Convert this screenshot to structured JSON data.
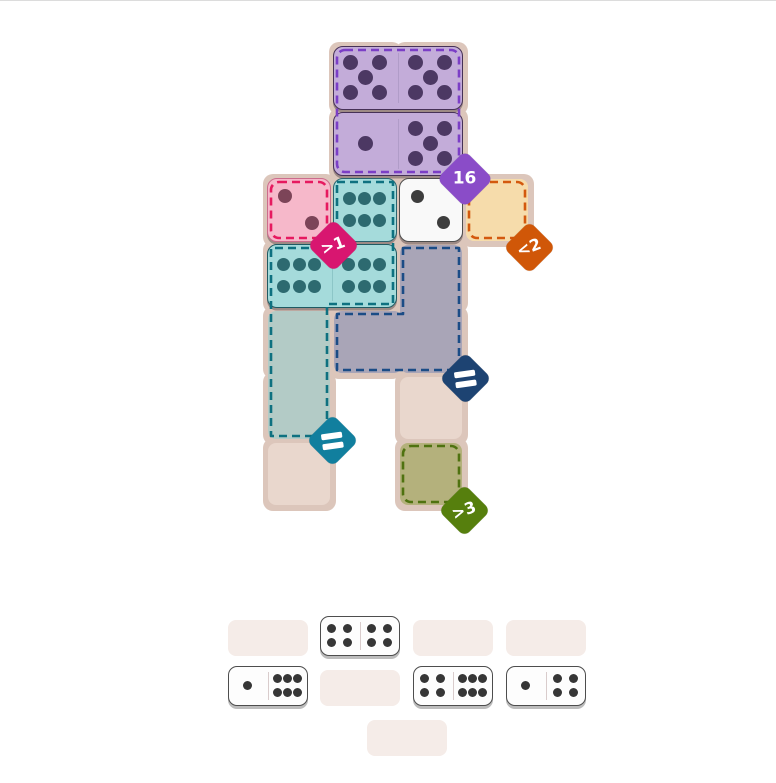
{
  "page": {
    "background": "#ffffff",
    "divider": {
      "y": 592,
      "color": "#dcdcdc"
    }
  },
  "board": {
    "grid": {
      "origin_x": 266,
      "origin_y": 45,
      "cell": 66
    },
    "casing_color": "#dcc6bb",
    "cell_color": "#e9d7cd",
    "base_cells": [
      [
        1,
        0
      ],
      [
        2,
        0
      ],
      [
        1,
        1
      ],
      [
        2,
        1
      ],
      [
        0,
        2
      ],
      [
        1,
        2
      ],
      [
        2,
        2
      ],
      [
        3,
        2
      ],
      [
        0,
        3
      ],
      [
        1,
        3
      ],
      [
        2,
        3
      ],
      [
        0,
        4
      ],
      [
        1,
        4
      ],
      [
        2,
        4
      ],
      [
        0,
        5
      ],
      [
        2,
        5
      ],
      [
        0,
        6
      ],
      [
        2,
        6
      ]
    ],
    "region_fills": [
      {
        "name": "region-cell-orange",
        "x": 466,
        "y": 179,
        "w": 62,
        "h": 62,
        "color": "#f6dcab"
      },
      {
        "name": "region-cell-olive",
        "x": 400,
        "y": 443,
        "w": 62,
        "h": 62,
        "color": "#b4b17c"
      },
      {
        "name": "region-cells-teal",
        "x": 268,
        "y": 311,
        "w": 62,
        "h": 128,
        "color": "#b3cbc6"
      },
      {
        "name": "region-cells-blue-right",
        "x": 400,
        "y": 245,
        "w": 62,
        "h": 128,
        "color": "#a9a5b7"
      },
      {
        "name": "region-cell-blue-left",
        "x": 334,
        "y": 311,
        "w": 68,
        "h": 62,
        "color": "#a9a5b7"
      }
    ],
    "region_outlines": [
      {
        "name": "purple",
        "type": "rect",
        "x": 337,
        "y": 50,
        "w": 122,
        "h": 122,
        "color": "#7b3ec6"
      },
      {
        "name": "pink",
        "type": "rect",
        "x": 271,
        "y": 182,
        "w": 56,
        "h": 56,
        "color": "#e6195f"
      },
      {
        "name": "orange",
        "type": "rect",
        "x": 469,
        "y": 182,
        "w": 56,
        "h": 56,
        "color": "#d3590e"
      },
      {
        "name": "olive",
        "type": "rect",
        "x": 403,
        "y": 446,
        "w": 56,
        "h": 56,
        "color": "#4f7210"
      },
      {
        "name": "teal",
        "type": "path",
        "d": "M 337 182 H 393 V 304 H 327 V 436 H 271 V 248 H 337 Z",
        "color": "#0e7180"
      },
      {
        "name": "blue",
        "type": "path",
        "d": "M 403 248 H 459 V 370 H 337 V 314 H 403 Z",
        "color": "#1b4c86"
      }
    ],
    "tiles": [
      {
        "name": "tile-domino-5-5",
        "x": 333,
        "y": 46,
        "w": 130,
        "h": 64,
        "halves": [
          5,
          5
        ],
        "fill": "#c3acd9",
        "stroke": "#463157",
        "divider": "#b09cc8",
        "pip": "#4c3863",
        "pip_size": 15
      },
      {
        "name": "tile-domino-1-5",
        "x": 333,
        "y": 112,
        "w": 130,
        "h": 64,
        "halves": [
          1,
          5
        ],
        "fill": "#c3acd9",
        "stroke": "#463157",
        "divider": "#b09cc8",
        "pip": "#4c3863",
        "pip_size": 15
      },
      {
        "name": "tile-half-2-pink",
        "x": 267,
        "y": 178,
        "w": 64,
        "h": 64,
        "halves": [
          2
        ],
        "fill": "#f6b8ca",
        "stroke": "#cc6c8c",
        "divider": null,
        "pip": "#7c4458",
        "pip_size": 14
      },
      {
        "name": "tile-half-6-teal",
        "x": 333,
        "y": 178,
        "w": 64,
        "h": 64,
        "halves": [
          6
        ],
        "fill": "#a5dbdb",
        "stroke": "#2a6570",
        "divider": null,
        "pip": "#2d6a70",
        "pip_size": 13
      },
      {
        "name": "tile-half-2-white",
        "x": 399,
        "y": 178,
        "w": 64,
        "h": 64,
        "halves": [
          2
        ],
        "fill": "#f9f9f9",
        "stroke": "#4e4e4e",
        "divider": null,
        "pip": "#3d3d3d",
        "pip_size": 13
      },
      {
        "name": "tile-domino-6-6",
        "x": 267,
        "y": 244,
        "w": 130,
        "h": 64,
        "halves": [
          6,
          6
        ],
        "fill": "#a5dbdb",
        "stroke": "#1f5b63",
        "divider": "#8cc6c7",
        "pip": "#2d6a70",
        "pip_size": 13
      }
    ],
    "badges": [
      {
        "name": "badge-sum-16",
        "label": "16",
        "kind": "text",
        "color": "#8a4cc8",
        "cx": 465,
        "cy": 179,
        "size": 40,
        "tilt": 0,
        "font": 17
      },
      {
        "name": "badge-gt-1",
        "label": ">1",
        "kind": "text",
        "color": "#d81670",
        "cx": 333,
        "cy": 245,
        "size": 37,
        "tilt": -20,
        "font": 16
      },
      {
        "name": "badge-lt-2",
        "label": "<2",
        "kind": "text",
        "color": "#d05708",
        "cx": 529,
        "cy": 247,
        "size": 37,
        "tilt": -20,
        "font": 16
      },
      {
        "name": "badge-eq-navy",
        "label": "=",
        "kind": "equals",
        "color": "#1d4372",
        "cx": 465,
        "cy": 378,
        "size": 37,
        "tilt": -8,
        "font": 16
      },
      {
        "name": "badge-eq-teal",
        "label": "=",
        "kind": "equals",
        "color": "#117f9e",
        "cx": 332,
        "cy": 440,
        "size": 37,
        "tilt": -8,
        "font": 16
      },
      {
        "name": "badge-gt-3",
        "label": ">3",
        "kind": "text",
        "color": "#567f0d",
        "cx": 464,
        "cy": 510,
        "size": 37,
        "tilt": -20,
        "font": 16
      }
    ]
  },
  "tray": {
    "slot_color": "#f5ece8",
    "slot_w": 80,
    "slot_h": 36,
    "slots": [
      {
        "x": 228,
        "y": 620
      },
      {
        "x": 413,
        "y": 620
      },
      {
        "x": 506,
        "y": 620
      },
      {
        "x": 320,
        "y": 670
      },
      {
        "x": 367,
        "y": 720
      }
    ],
    "domino_w": 80,
    "domino_h": 40,
    "domino_fill": "#fdfdfd",
    "domino_stroke": "#4d4d4d",
    "divider_color": "#d9cccc",
    "pip_color": "#363636",
    "pip_size": 9,
    "dominoes": [
      {
        "name": "tray-domino-4-4",
        "x": 320,
        "y": 616,
        "halves": [
          4,
          4
        ]
      },
      {
        "name": "tray-domino-1-6",
        "x": 228,
        "y": 666,
        "halves": [
          1,
          6
        ]
      },
      {
        "name": "tray-domino-4-6",
        "x": 413,
        "y": 666,
        "halves": [
          4,
          6
        ]
      },
      {
        "name": "tray-domino-1-4",
        "x": 506,
        "y": 666,
        "halves": [
          1,
          4
        ]
      }
    ]
  }
}
